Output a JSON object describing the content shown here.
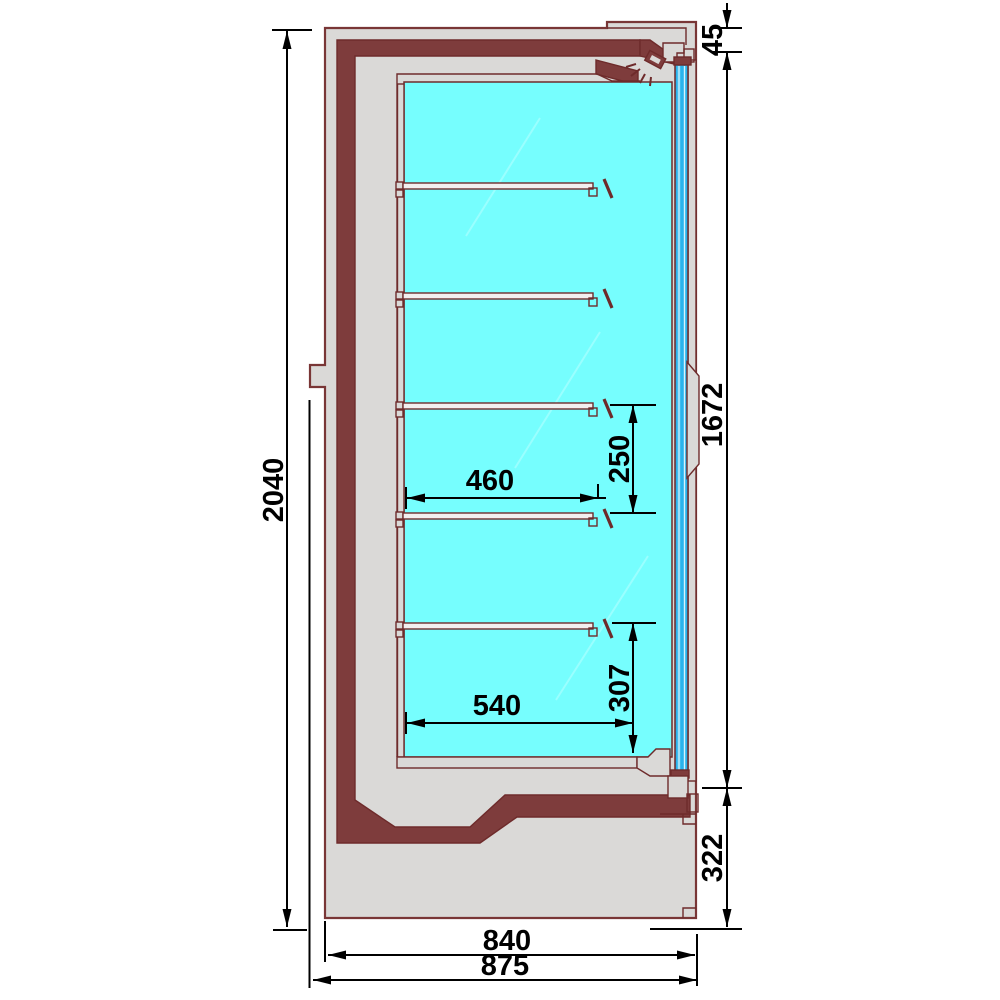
{
  "drawing": {
    "type": "technical-cross-section",
    "subject": "refrigerated wall display cabinet - side section",
    "dimensions_mm": {
      "overall_height": "2040",
      "top_frame": "45",
      "glass_door_height": "1672",
      "base_section_height": "322",
      "shelf_spacing": "250",
      "shelf_depth": "460",
      "bottom_gap": "307",
      "bottom_deck_depth": "540",
      "body_depth": "840",
      "overall_depth": "875"
    },
    "colors": {
      "outline": "#6E2B2B",
      "insulation_panel": "#7E3C3C",
      "body_gray": "#DAD9D7",
      "interior_cyan": "#76FEFE",
      "door_glass_blue": "#2AB3EC",
      "dimension_black": "#000000"
    }
  }
}
